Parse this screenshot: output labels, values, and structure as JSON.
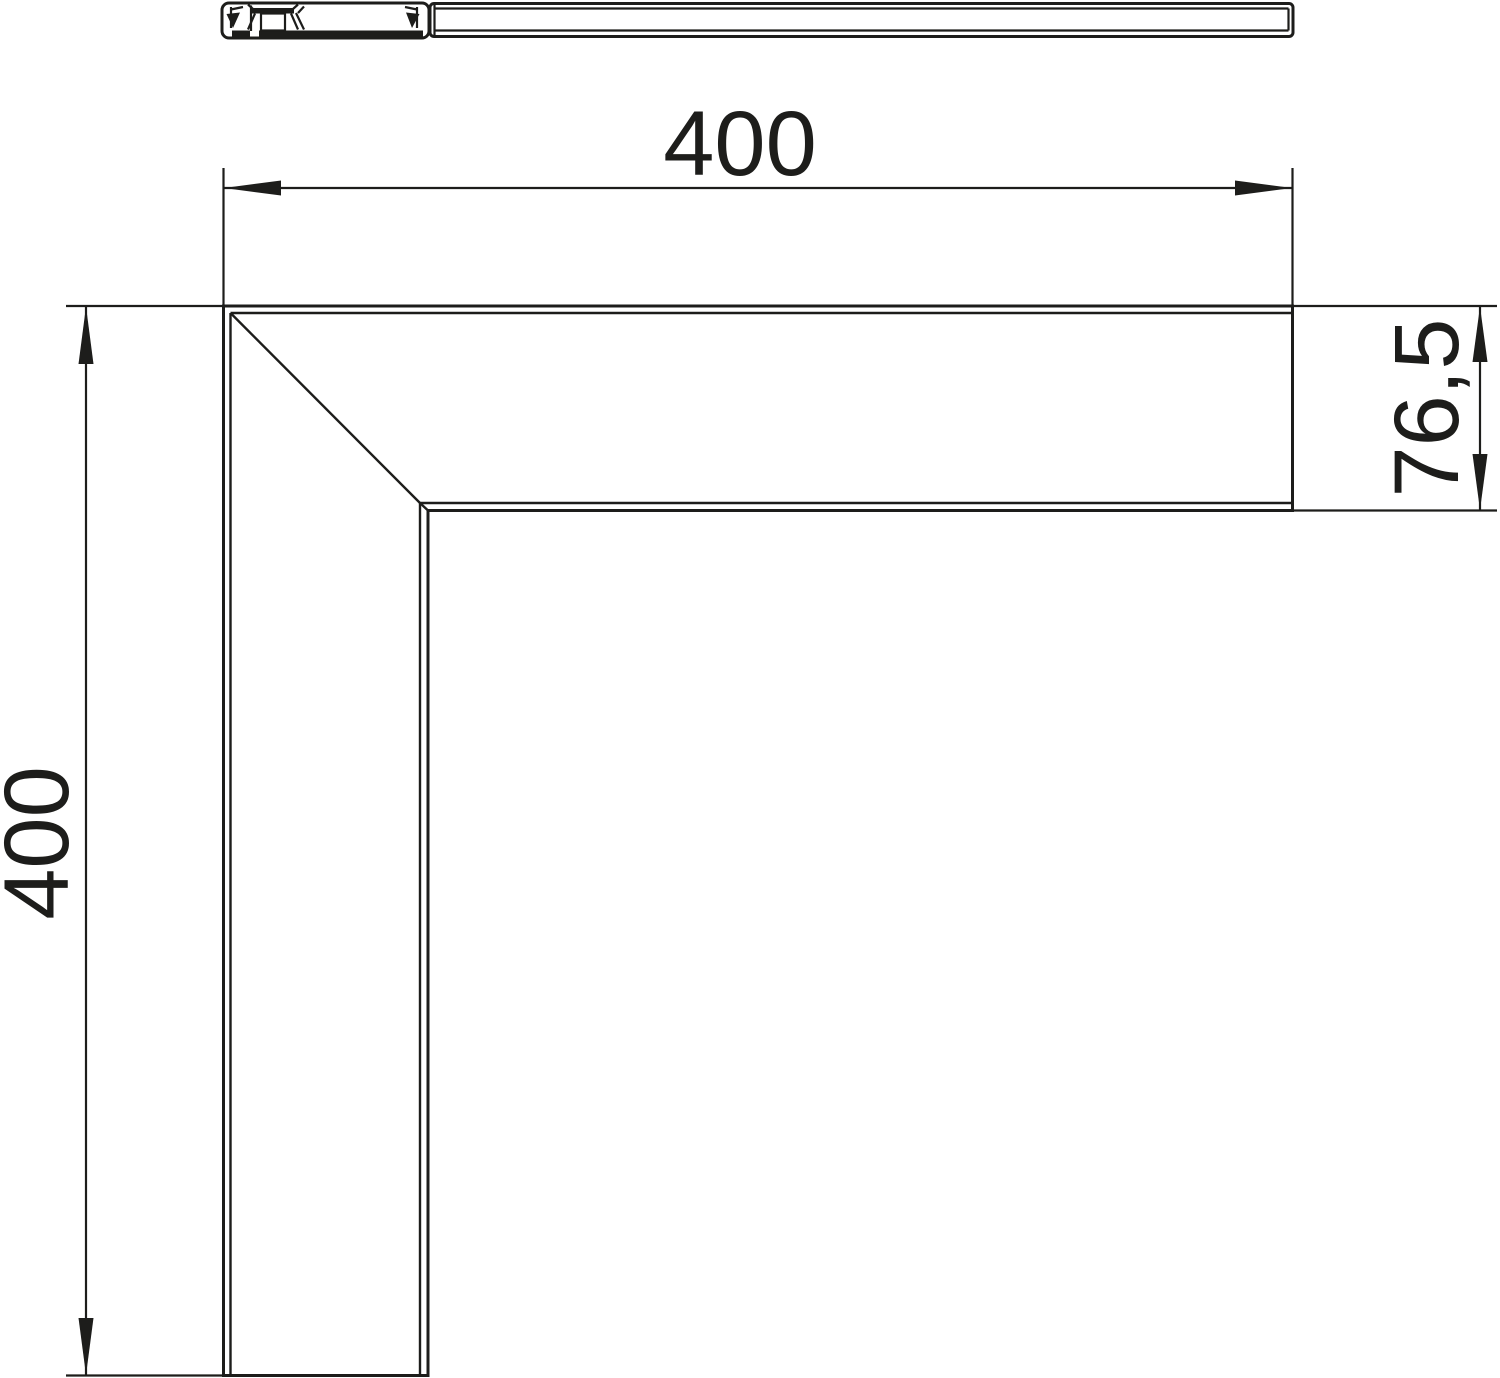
{
  "page": {
    "background_color": "#ffffff"
  },
  "drawing": {
    "stroke_color": "#1d1d1b",
    "dimensions": {
      "horizontal": {
        "label": "400"
      },
      "vertical": {
        "label": "400"
      },
      "side": {
        "label": "76,5"
      }
    }
  }
}
